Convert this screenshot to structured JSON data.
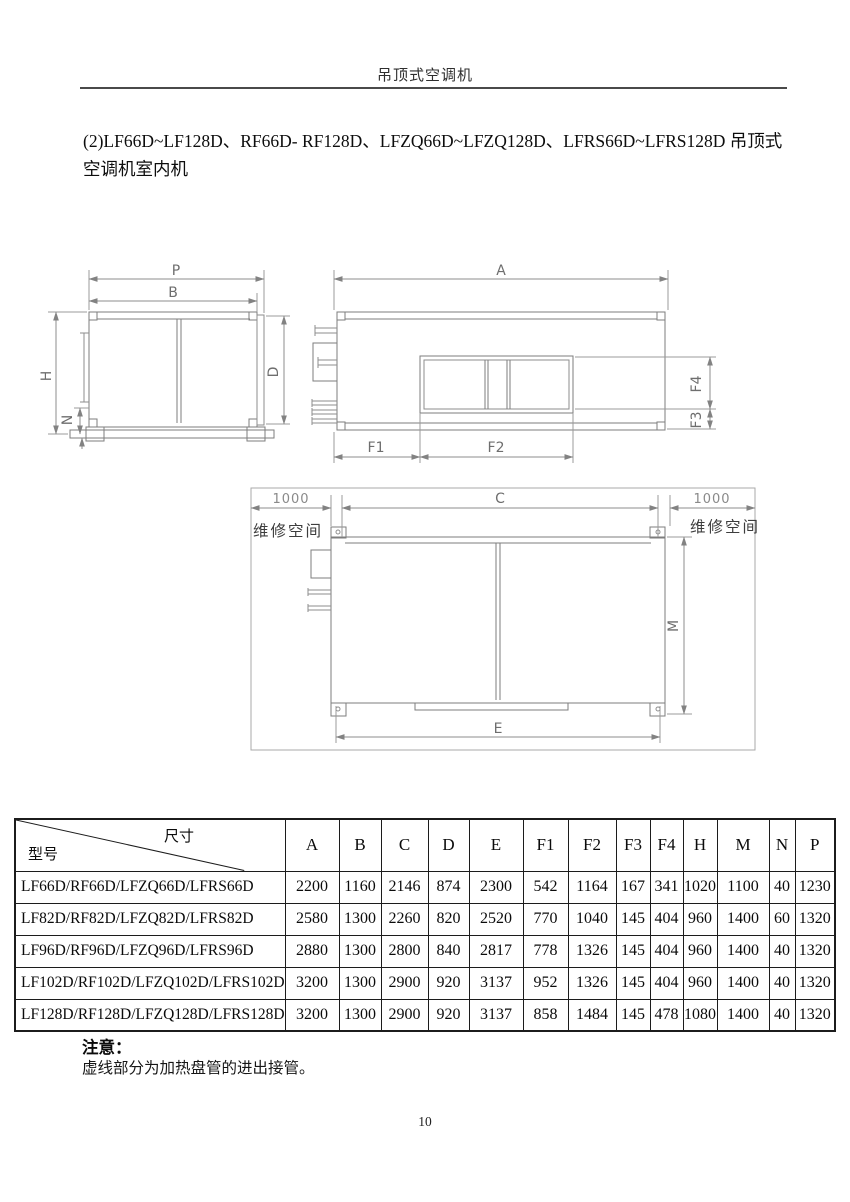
{
  "header": {
    "title": "吊顶式空调机"
  },
  "intro": {
    "text": "(2)LF66D~LF128D、RF66D- RF128D、LFZQ66D~LFZQ128D、LFRS66D~LFRS128D 吊顶式空调机室内机"
  },
  "colors": {
    "drawing_line": "#7d7d7d",
    "dimension_text": "#6e6e6e",
    "table_border": "#1c1c1c"
  },
  "drawings": {
    "side_view": {
      "p": "P",
      "b": "B",
      "h": "H",
      "n": "N",
      "d": "D"
    },
    "front_view": {
      "a": "A",
      "f1": "F1",
      "f2": "F2",
      "f3": "F3",
      "f4": "F4"
    },
    "bottom_view": {
      "c": "C",
      "e": "E",
      "m": "M",
      "left_clearance": "1000",
      "right_clearance": "1000",
      "left_service": "维修空间",
      "right_service": "维修空间"
    }
  },
  "table": {
    "corner": {
      "top_label": "尺寸",
      "bottom_label": "型号"
    },
    "columns": [
      "A",
      "B",
      "C",
      "D",
      "E",
      "F1",
      "F2",
      "F3",
      "F4",
      "H",
      "M",
      "N",
      "P"
    ],
    "rows": [
      {
        "model": "LF66D/RF66D/LFZQ66D/LFRS66D",
        "values": [
          "2200",
          "1160",
          "2146",
          "874",
          "2300",
          "542",
          "1164",
          "167",
          "341",
          "1020",
          "1100",
          "40",
          "1230"
        ]
      },
      {
        "model": "LF82D/RF82D/LFZQ82D/LFRS82D",
        "values": [
          "2580",
          "1300",
          "2260",
          "820",
          "2520",
          "770",
          "1040",
          "145",
          "404",
          "960",
          "1400",
          "60",
          "1320"
        ]
      },
      {
        "model": "LF96D/RF96D/LFZQ96D/LFRS96D",
        "values": [
          "2880",
          "1300",
          "2800",
          "840",
          "2817",
          "778",
          "1326",
          "145",
          "404",
          "960",
          "1400",
          "40",
          "1320"
        ]
      },
      {
        "model": "LF102D/RF102D/LFZQ102D/LFRS102D",
        "values": [
          "3200",
          "1300",
          "2900",
          "920",
          "3137",
          "952",
          "1326",
          "145",
          "404",
          "960",
          "1400",
          "40",
          "1320"
        ]
      },
      {
        "model": "LF128D/RF128D/LFZQ128D/LFRS128D",
        "values": [
          "3200",
          "1300",
          "2900",
          "920",
          "3137",
          "858",
          "1484",
          "145",
          "478",
          "1080",
          "1400",
          "40",
          "1320"
        ]
      }
    ]
  },
  "note": {
    "label": "注意：",
    "text": "虚线部分为加热盘管的进出接管。"
  },
  "footer": {
    "page_number": "10"
  }
}
